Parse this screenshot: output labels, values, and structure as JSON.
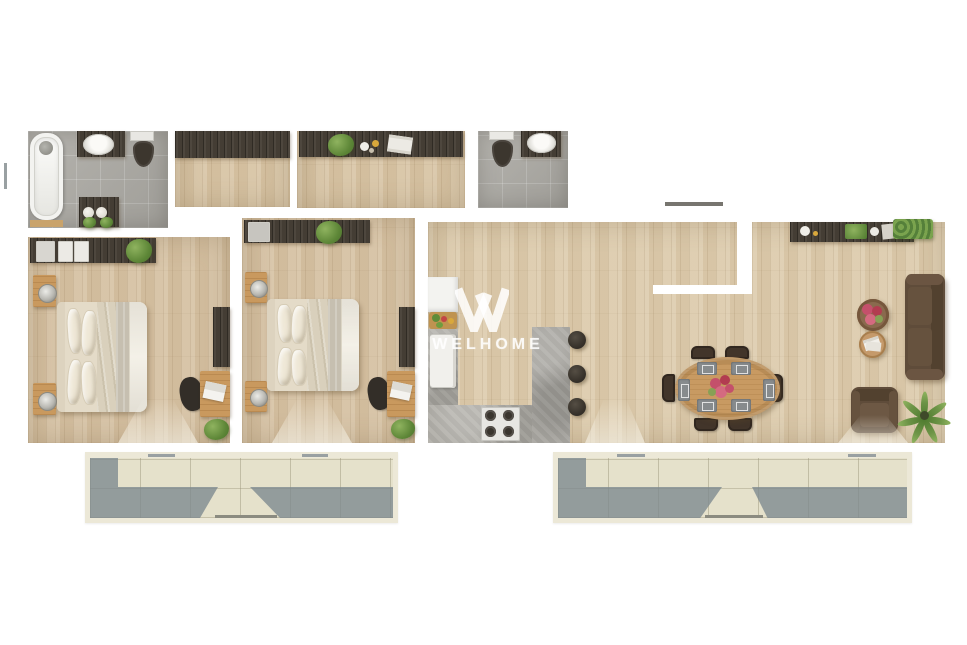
{
  "watermark": {
    "text": "WELHOME",
    "logo": "welhome-w-logo"
  },
  "palette": {
    "page": "#ffffff",
    "wood": "#d6c2a4",
    "wood-open": "#ddccae",
    "wood-hall": "#d8c5a6",
    "tile": "#adaba5",
    "dark": "#443d34",
    "tan": "#c9995e",
    "concrete": "#b2b0aa",
    "linen": "#e9e2d2",
    "sofa": "#5f4c3a",
    "green": "#5d8637",
    "red": "#c0455c",
    "btile": "#e5e1cb",
    "cream": "#ece8d7",
    "white-fix": "#f3f3f0"
  },
  "floor_plan": {
    "type": "apartment-top-view-render",
    "rooms": [
      {
        "name": "bathroom",
        "floor": "gray-tile",
        "furniture": [
          "bathtub",
          "shower-mixer",
          "washbasin-counter",
          "toilet",
          "vanity-cabinet",
          "towel-rolls",
          "plants"
        ]
      },
      {
        "name": "hall-closet",
        "floor": "wood",
        "furniture": [
          "wardrobe"
        ]
      },
      {
        "name": "entry-hall",
        "floor": "wood",
        "furniture": [
          "console-sideboard",
          "plant",
          "decor-bowls",
          "magazines"
        ]
      },
      {
        "name": "wc",
        "floor": "gray-tile",
        "furniture": [
          "toilet",
          "washbasin-counter"
        ]
      },
      {
        "name": "bedroom-1",
        "floor": "wood",
        "furniture": [
          "wardrobe",
          "wardrobe-plant",
          "double-bed",
          "nightstand-lamp-top",
          "nightstand-lamp-bottom",
          "tv-dresser",
          "desk",
          "laptop",
          "desk-chair",
          "desk-plant"
        ]
      },
      {
        "name": "bedroom-2",
        "floor": "wood",
        "furniture": [
          "wardrobe",
          "wardrobe-plant",
          "double-bed",
          "nightstand-lamp-top",
          "nightstand-lamp-bottom",
          "tv-dresser",
          "desk",
          "laptop",
          "desk-chair",
          "desk-plant"
        ]
      },
      {
        "name": "kitchen",
        "floor": "wood",
        "furniture": [
          "tall-cabinet",
          "cutting-board",
          "fridge",
          "l-counter",
          "gas-hob",
          "bar-island",
          "bar-stool-1",
          "bar-stool-2",
          "bar-stool-3"
        ]
      },
      {
        "name": "dining-area",
        "floor": "wood",
        "furniture": [
          "oval-table",
          "flower-centerpiece",
          "placemats-x6",
          "dining-chairs-x6"
        ]
      },
      {
        "name": "living-area",
        "floor": "wood",
        "furniture": [
          "wall-console",
          "decor-bowl",
          "planter-box",
          "hedge-planter",
          "sofa",
          "coffee-table-flowers",
          "side-table-magazines",
          "armchair",
          "palm-plant"
        ]
      },
      {
        "name": "balcony-left",
        "floor": "beige-tile",
        "furniture": [
          "railing",
          "door-thresholds"
        ]
      },
      {
        "name": "balcony-right",
        "floor": "beige-tile",
        "furniture": [
          "railing",
          "door-thresholds"
        ]
      }
    ]
  }
}
